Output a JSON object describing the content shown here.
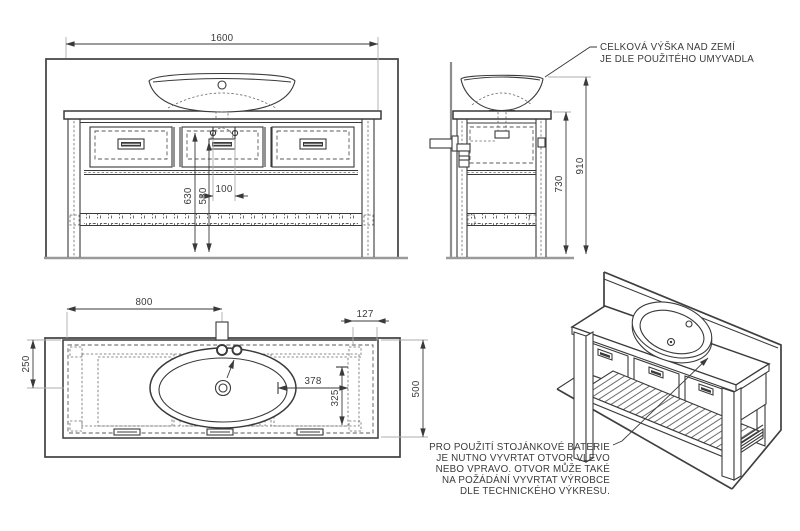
{
  "front_view": {
    "dim_width": "1600",
    "dim_height_left": "630",
    "dim_height_right": "580",
    "dim_tap_spacing": "100"
  },
  "side_view": {
    "dim_height_total": "910",
    "dim_height_frame": "730",
    "note_line1": "CELKOVÁ VÝŠKA NAD ZEMÍ",
    "note_line2": "JE DLE POUŽITÉHO UMYVADLA"
  },
  "plan_view": {
    "dim_tap_from_left": "800",
    "dim_right_overhang": "127",
    "dim_tap_from_back": "250",
    "dim_depth": "500",
    "dim_sink_offset_h": "378",
    "dim_sink_offset_v": "325"
  },
  "iso_view": {
    "note_line1": "PRO POUŽITÍ STOJÁNKOVÉ BATERIE",
    "note_line2": "JE NUTNO VYVRTAT OTVOR VLEVO",
    "note_line3": "NEBO VPRAVO. OTVOR MŮŽE TAKÉ",
    "note_line4": "NA POŽÁDÁNÍ VYVRTAT VÝROBCE",
    "note_line5": "DLE TECHNICKÉHO VÝKRESU."
  },
  "icons": {
    "centerline_mark": "centerline-mark",
    "leader_arrow": "leader-arrow"
  },
  "colors": {
    "line": "#3a3a3a",
    "gray": "#9a9a9a",
    "background": "#ffffff"
  }
}
